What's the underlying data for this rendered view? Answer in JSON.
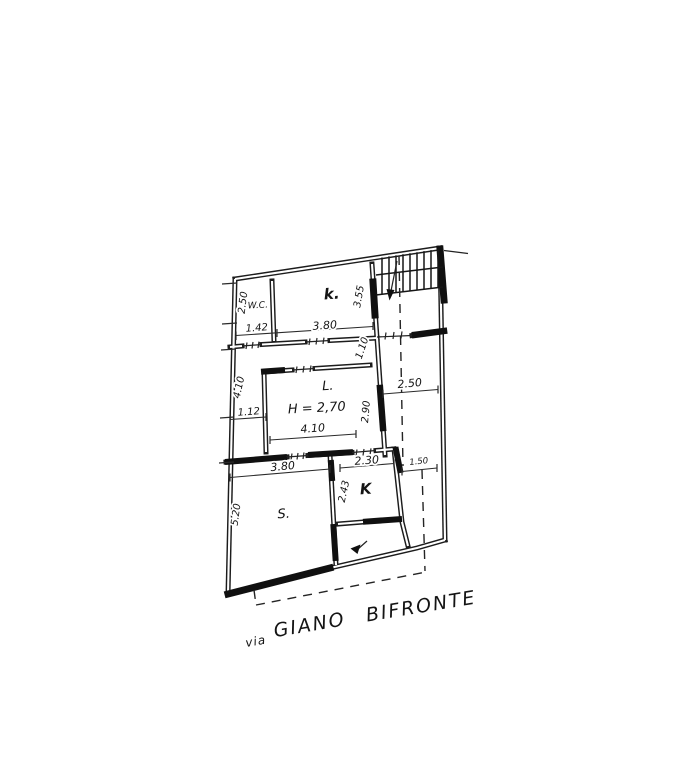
{
  "page": {
    "background": "#ffffff",
    "ink": "#1a1a1a"
  },
  "floor_plan": {
    "rooms": {
      "wc": "W.C.",
      "bedroom": "k.",
      "living": "L.",
      "living_height": "H = 2,70",
      "soggiorno": "S.",
      "kitchen": "K"
    },
    "dimensions": {
      "wc_width": "1.42",
      "bedroom_width": "3.80",
      "wc_height": "2.50",
      "bedroom_height": "3.55",
      "corridor_width": "1.10",
      "hall_depth": "4.10",
      "closet_width": "1.12",
      "living_width": "4.10",
      "living_depth": "2.90",
      "terrace_width": "2.50",
      "soggiorno_width": "3.80",
      "kitchen_width": "2.30",
      "terrace_lower_width": "1.50",
      "kitchen_depth": "2.43",
      "soggiorno_depth": "5.20"
    },
    "street": {
      "prefix": "via",
      "name": "GIANO BIFRONTE"
    }
  }
}
